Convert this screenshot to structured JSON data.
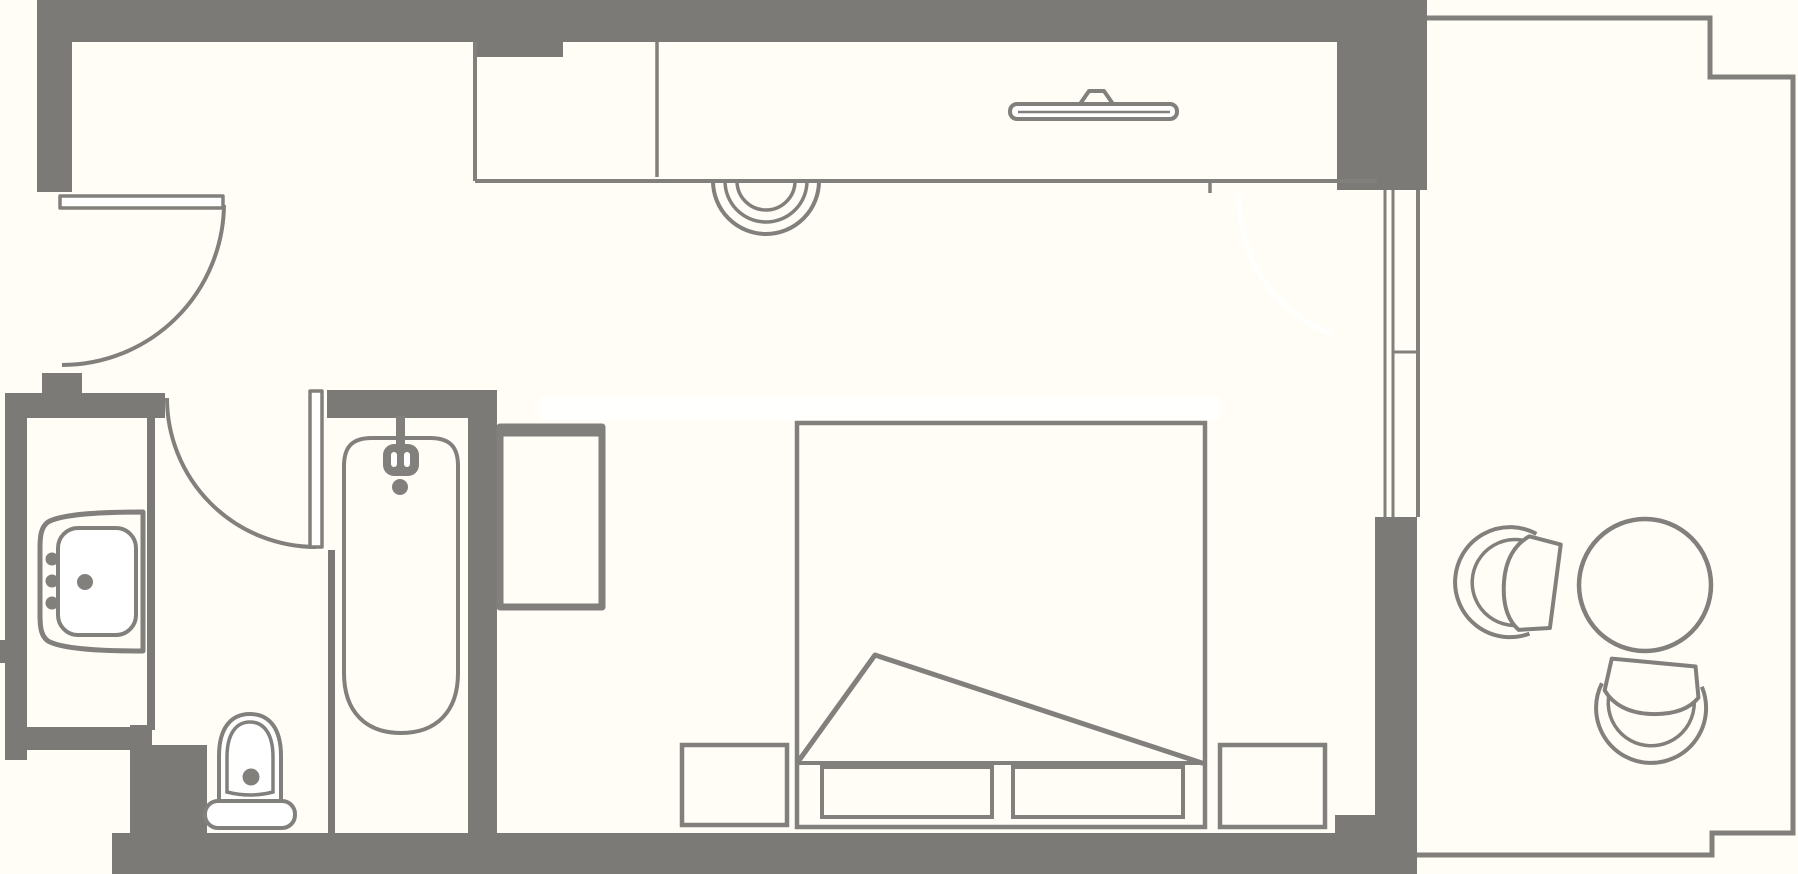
{
  "document": {
    "type": "floor-plan",
    "description": "Architectural line-drawing floor plan of a hotel room with bathroom, wardrobe corridor, bedroom and balcony. No text labels are rendered in the drawing."
  },
  "colors": {
    "background": "#fffdf6",
    "wall": "#7b7a77",
    "line": "#82807c",
    "white": "#ffffff"
  },
  "rooms": [
    {
      "name": "entry-vestibule"
    },
    {
      "name": "sink-area"
    },
    {
      "name": "toilet-area"
    },
    {
      "name": "bathtub-room"
    },
    {
      "name": "wardrobe-corridor"
    },
    {
      "name": "bedroom"
    },
    {
      "name": "balcony"
    }
  ],
  "furniture": [
    {
      "label": "entry door with swing arc"
    },
    {
      "label": "bathroom door with swing arc"
    },
    {
      "label": "washbasin vanity"
    },
    {
      "label": "toilet"
    },
    {
      "label": "bathtub with shower faucet"
    },
    {
      "label": "tall cabinet"
    },
    {
      "label": "wardrobe with wall-mounted TV"
    },
    {
      "label": "decorative wall arcs"
    },
    {
      "label": "double bed with folded blanket"
    },
    {
      "label": "left nightstand"
    },
    {
      "label": "right nightstand"
    },
    {
      "label": "under-bed drawers"
    },
    {
      "label": "sliding window to balcony"
    },
    {
      "label": "balcony round table"
    },
    {
      "label": "balcony tub chair left"
    },
    {
      "label": "balcony tub chair bottom"
    }
  ]
}
